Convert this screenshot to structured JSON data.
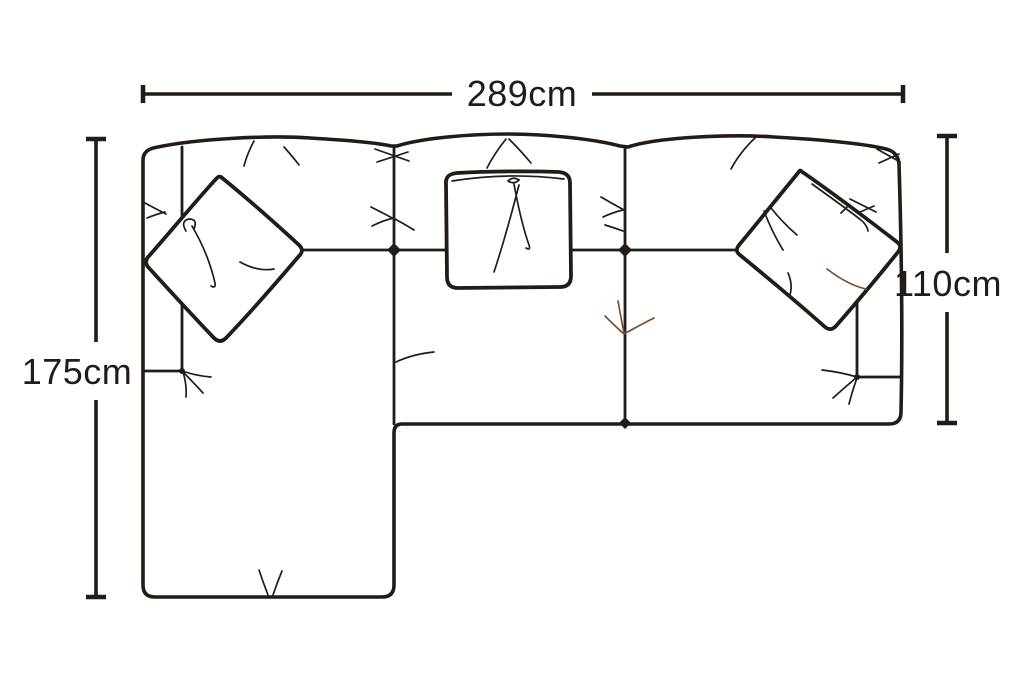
{
  "page": {
    "background": "#ffffff"
  },
  "diagram": {
    "subject": "corner-chaise-sofa-top-view",
    "ink_color": "#211c17",
    "accent_crease_color": "#7d4e2e",
    "dimensions": {
      "width": {
        "label": "289cm",
        "value": 289,
        "unit": "cm"
      },
      "depth_left": {
        "label": "175cm",
        "value": 175,
        "unit": "cm"
      },
      "depth_right": {
        "label": "110cm",
        "value": 110,
        "unit": "cm"
      }
    }
  }
}
